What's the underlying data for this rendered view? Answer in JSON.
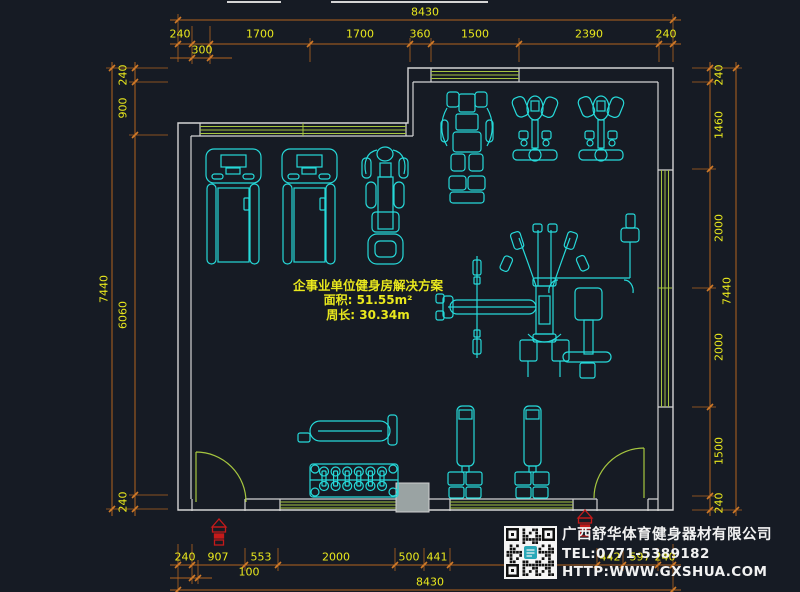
{
  "annotation": {
    "title": "企事业单位健身房解决方案",
    "area": "面积: 51.55m²",
    "perimeter": "周长: 30.34m"
  },
  "company": {
    "name": "广西舒华体育健身器材有限公司",
    "tel": "TEL:0771-5389182",
    "website": "HTTP:WWW.GXSHUA.COM"
  },
  "dimensions": {
    "top": {
      "overall": "8430",
      "segments": [
        "240",
        "1700",
        "1700",
        "360",
        "1500",
        "2390",
        "240"
      ],
      "sub": "300"
    },
    "bottom": {
      "overall": "8430",
      "segments": [
        "240",
        "907",
        "553",
        "2000",
        "500",
        "441",
        "2510",
        "442",
        "597",
        "240"
      ],
      "sub": "100"
    },
    "left": {
      "overall": "7440",
      "segments": [
        "240",
        "900",
        "6060",
        "240"
      ]
    },
    "right": {
      "overall": "7440",
      "segments": [
        "240",
        "1460",
        "2000",
        "2000",
        "1500",
        "240"
      ]
    }
  },
  "equipment_blocks": [
    "treadmill",
    "treadmill",
    "recumbent-bike",
    "strength-machine",
    "lat-pulldown",
    "lat-pulldown",
    "multi-station",
    "weight-tower",
    "weight-tower",
    "flat-bench",
    "dumbbell-rack"
  ],
  "icons": {
    "qr": "qr-code",
    "alert": "fire-hydrant"
  },
  "colors": {
    "background": "#161b24",
    "wall": "#d4d4d4",
    "window_green": "#a6c63f",
    "dimension_line": "#b2631e",
    "dimension_text": "#e9e81d",
    "equipment_cyan": "#26d9d9",
    "company_text": "#f2f2f2",
    "alert_red": "#c41a1a",
    "column_fill": "#9aa3a3"
  }
}
